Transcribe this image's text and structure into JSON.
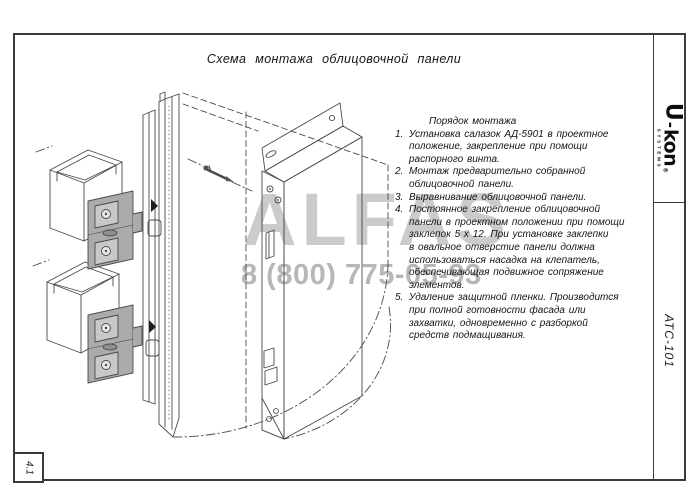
{
  "page": {
    "frame_color": "#3b3b3b",
    "line_color": "#4a4a4a",
    "bracket_fill": "#ababab",
    "background": "#ffffff"
  },
  "title": "Схема монтажа облицовочной панели",
  "instructions": {
    "heading": "Порядок монтажа",
    "items": [
      {
        "num": "1.",
        "text": "Установка салазок АД-5901 в проектное\nположение, закрепление при помощи\nраспорного винта."
      },
      {
        "num": "2.",
        "text": "Монтаж предварительно собранной\nоблицовочной панели."
      },
      {
        "num": "3.",
        "text": "Выравнивание облицовочной панели."
      },
      {
        "num": "4.",
        "text": "Постоянное закрепление облицовочной\nпанели в проектном положении при помощи\nзаклепок 5 х 12.  При установке заклепки\nв овальное отверстие панели должна\nиспользоваться насадка на клепатель,\nобеспечивающая подвижное сопряжение\nэлементов."
      },
      {
        "num": "5.",
        "text": "Удаление защитной пленки. Производится\nпри полной готовности фасада или\nзахватки, одновременно с разборкой\nсредств подмащивания."
      }
    ]
  },
  "watermark": {
    "brand": "ALFAS",
    "phone": "8 (800) 775-05-93",
    "brand_color": "#cbcbcb",
    "phone_color": "#b7b7b7"
  },
  "logo": {
    "brand_u": "U",
    "hyphen": "-",
    "brand_rest": "kon",
    "mark": "®",
    "sub": "SYSTEMS"
  },
  "stamp": {
    "doc_number": "АТС-101",
    "sheet_number": "4.1"
  }
}
